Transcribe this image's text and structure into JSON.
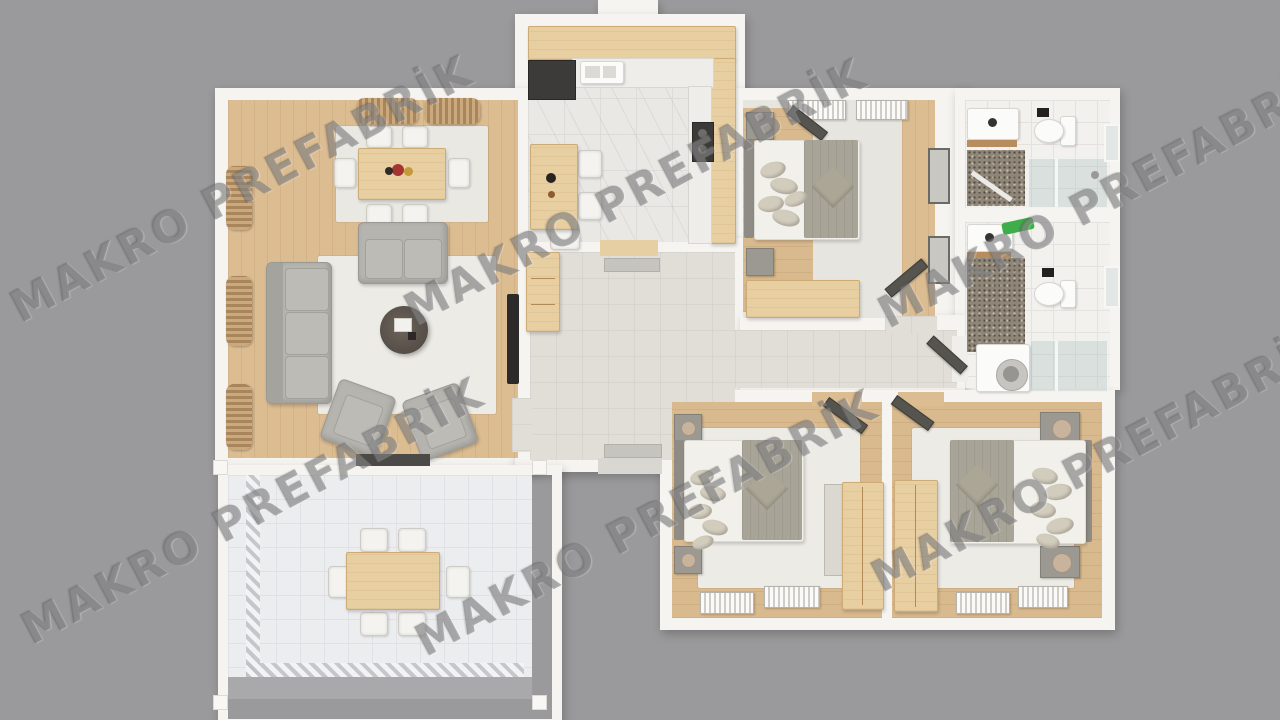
{
  "watermark": {
    "text": "MAKRO PREFABRİK",
    "color": "#646365"
  },
  "palette": {
    "background": "#9a999b",
    "wall": "#f6f4f0",
    "wood_floor": "#dcbd92",
    "wood_furniture": "#e8cfa2",
    "rug": "#e9e8e2",
    "sofa_gray": "#b6b4af",
    "blanket_gray": "#a8a497",
    "shower_floor": "#8f8678",
    "glass": "#afc6c3",
    "towel_green": "#3fae4a",
    "flowers_red": "#a43332",
    "flowers_yellow": "#c49a3a",
    "appliance_dark": "#3c3b39"
  },
  "rooms": [
    {
      "name": "living-room",
      "furniture": [
        "dining-table-6-chairs",
        "flower-centerpiece",
        "loveseat",
        "three-seat-sofa",
        "round-coffee-table",
        "two-armchairs",
        "wall-tv",
        "window-curtains"
      ]
    },
    {
      "name": "kitchen",
      "furniture": [
        "u-shaped-counter",
        "sink",
        "cooktop",
        "fridge",
        "breakfast-table",
        "three-chairs"
      ]
    },
    {
      "name": "hallway",
      "furniture": [
        "sideboard",
        "doormats"
      ]
    },
    {
      "name": "master-bedroom",
      "furniture": [
        "double-bed",
        "two-nightstands",
        "two-radiators",
        "desk",
        "open-door"
      ]
    },
    {
      "name": "bathroom-top",
      "furniture": [
        "vanity-sink",
        "toilet",
        "glass-shower",
        "window"
      ]
    },
    {
      "name": "bathroom-bottom",
      "furniture": [
        "vanity-sink",
        "green-towel",
        "toilet",
        "glass-shower",
        "washing-machine",
        "window"
      ]
    },
    {
      "name": "bedroom-2",
      "furniture": [
        "double-bed",
        "two-nightstands",
        "wardrobe",
        "dresser",
        "two-radiators",
        "open-door"
      ]
    },
    {
      "name": "bedroom-3",
      "furniture": [
        "double-bed",
        "two-nightstands-with-lamps",
        "wardrobe",
        "two-radiators",
        "open-door"
      ]
    },
    {
      "name": "terrace",
      "furniture": [
        "outdoor-dining-table",
        "six-chairs",
        "mosaic-tile-border"
      ]
    }
  ]
}
